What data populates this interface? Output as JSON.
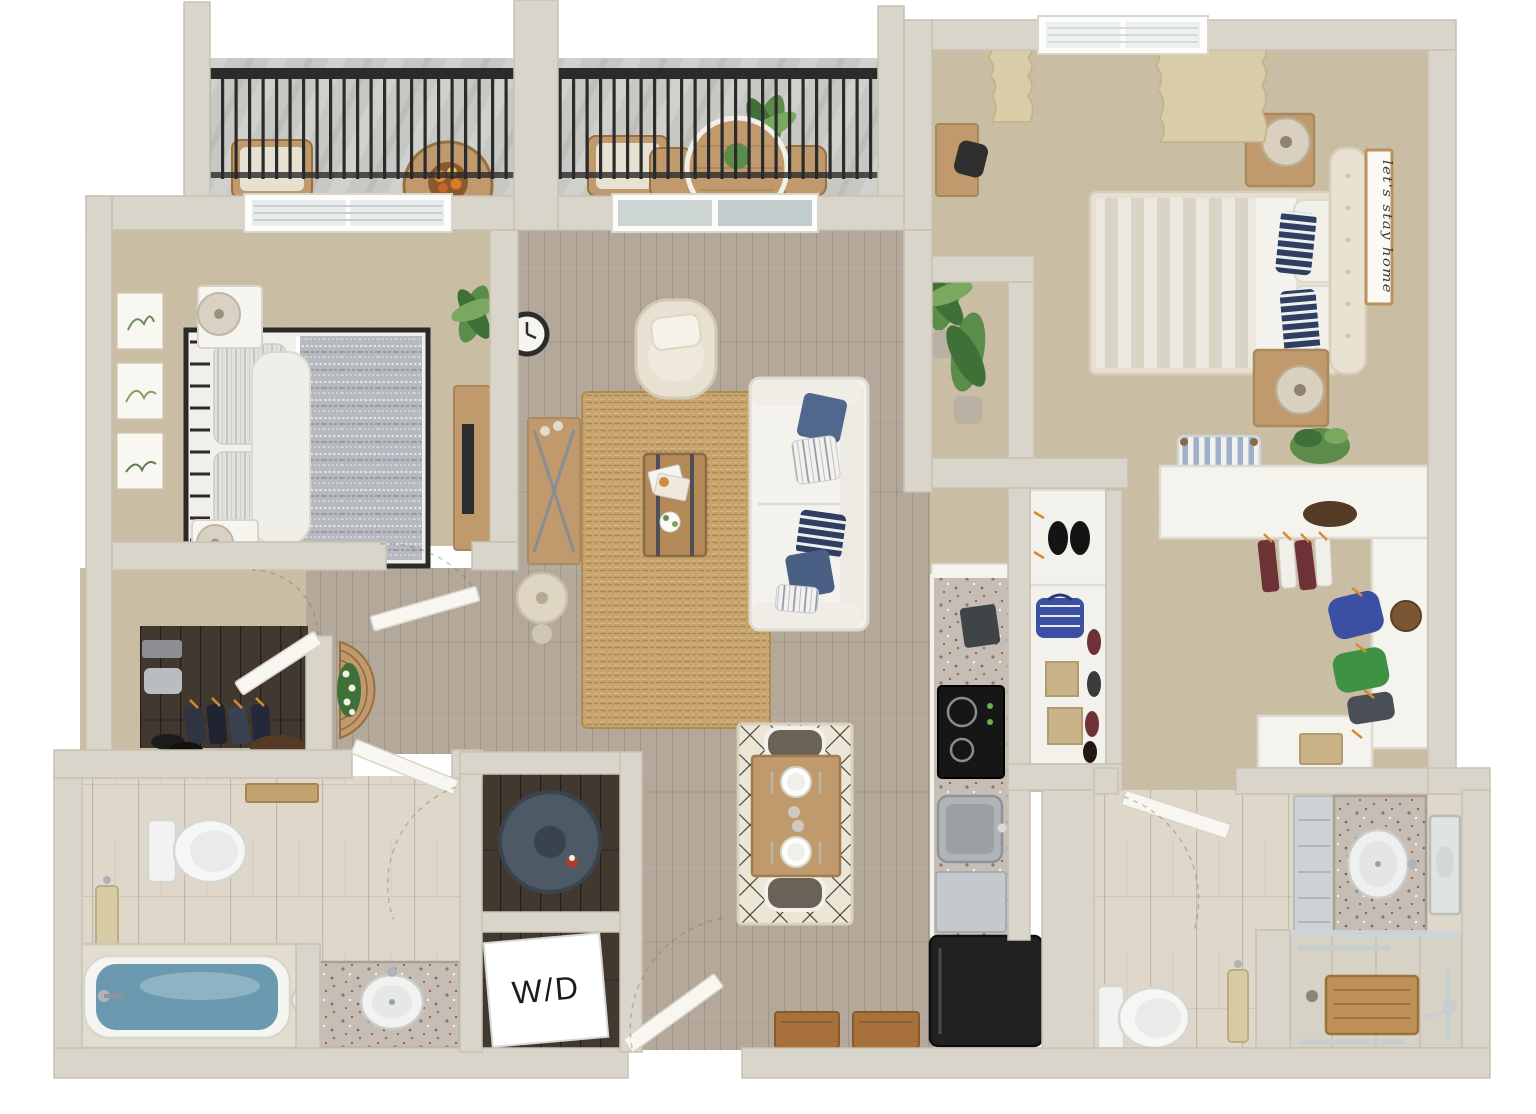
{
  "labels": {
    "washer_dryer": "W/D",
    "bedroom_sign": "let's stay home"
  },
  "palette": {
    "wall": "#d9d5ca",
    "wallEdge": "#c7c2b3",
    "wood": "#b3a89a",
    "carpet": "#c9bda3",
    "tile": "#ded7ca",
    "concrete": "#c7c8c4",
    "granite": "#c6beb5",
    "jute": "#c8a56e",
    "creamRug": "#ece6d6",
    "white": "#f4f2ec",
    "navy": "#51688e",
    "navyDeep": "#2e3f63",
    "steel": "#aeb4b8",
    "black": "#2b2b2b",
    "fridge": "#212121",
    "water": "#6b9ab0",
    "plant": "#5b8c4a",
    "plantDark": "#3e7038",
    "curtain": "#d9cca9",
    "towel": "#d7cba4",
    "woodFurn": "#c09a6c",
    "woodDark": "#997948",
    "mat": "#a8703b",
    "maroon": "#6e3136",
    "blueCloth": "#3c50a3",
    "greenCloth": "#3f9144",
    "bagBrown": "#553a26",
    "heater": "#4d5a66",
    "darkFloor": "#41392f",
    "signInk": "#3f3b35"
  }
}
